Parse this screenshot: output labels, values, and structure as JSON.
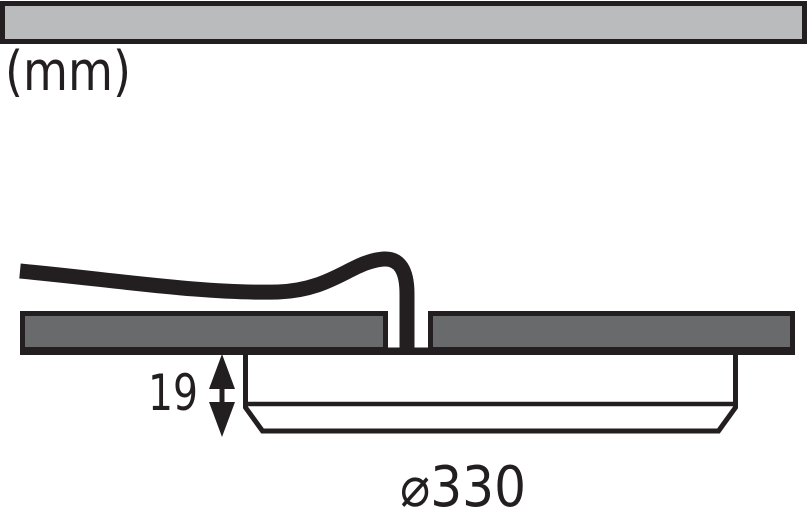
{
  "diagram": {
    "kind": "technical-dimension-drawing",
    "labels": {
      "units": "(mm)",
      "depth": "19",
      "diameter": "⌀330"
    },
    "dimensions": {
      "unit": "mm",
      "depth_below_ceiling_mm": 19,
      "diameter_mm": 330
    },
    "colors": {
      "line": "#231f20",
      "ceiling_bar_fill": "#babbbd",
      "panel_fill": "#696a6c",
      "fixture_fill": "#ffffff",
      "background": "#ffffff"
    }
  }
}
